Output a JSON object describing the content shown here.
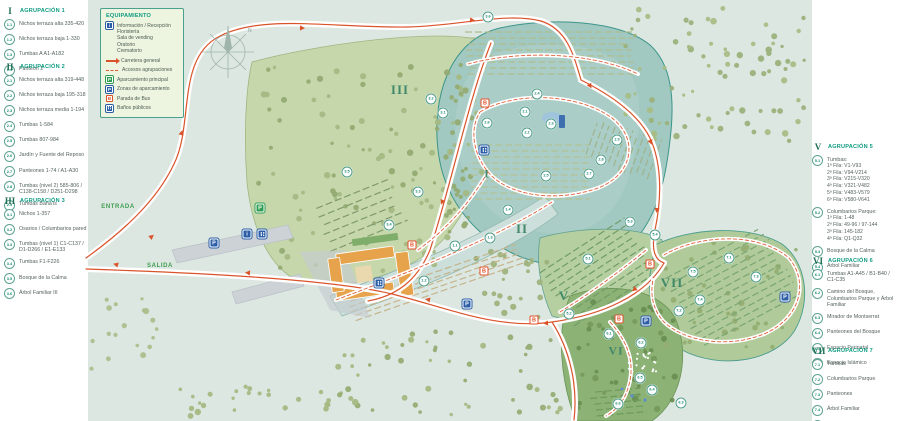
{
  "equipment": {
    "title": "EQUIPAMIENTO",
    "items": [
      {
        "icon": "info-icon",
        "lines": [
          "Información / Recepción",
          "Floristería",
          "Sala de vending",
          "Oratorio",
          "Crematorio"
        ]
      },
      {
        "icon": "main-road-icon",
        "lines": [
          "Carretera general"
        ]
      },
      {
        "icon": "access-road-icon",
        "lines": [
          "Accesos agrupaciones"
        ]
      },
      {
        "icon": "parking-main-icon",
        "lines": [
          "Aparcamiento principal"
        ]
      },
      {
        "icon": "parking-zone-icon",
        "lines": [
          "Zonas de aparcamiento"
        ]
      },
      {
        "icon": "bus-stop-icon",
        "lines": [
          "Parada de Bus"
        ]
      },
      {
        "icon": "wc-icon",
        "lines": [
          "Baños públicos"
        ]
      }
    ]
  },
  "legend_left": {
    "sections": [
      {
        "numeral": "I",
        "title": "AGRUPACIÓN 1",
        "top": 6,
        "items": [
          {
            "id": "1.1",
            "text": "Nichos terraza alta 335-420"
          },
          {
            "id": "1.2",
            "text": "Nichos terraza baja 1-330"
          },
          {
            "id": "1.3",
            "text": "Tumbas A A1-A182"
          },
          {
            "id": "1.4",
            "text": "Panteón 2"
          }
        ]
      },
      {
        "numeral": "II",
        "title": "AGRUPACIÓN 2",
        "top": 62,
        "items": [
          {
            "id": "2.1",
            "text": "Nichos terraza alta 319-448"
          },
          {
            "id": "2.2",
            "text": "Nichos terraza baja 195-318"
          },
          {
            "id": "2.3",
            "text": "Nichos terraza media 1-194"
          },
          {
            "id": "2.4",
            "text": "Tumbas 1-584"
          },
          {
            "id": "2.5",
            "text": "Tumbas 807-984"
          },
          {
            "id": "2.6",
            "text": "Jardín y Fuente del Reposo"
          },
          {
            "id": "2.7",
            "text": "Panteones 1-74 / A1-A30"
          },
          {
            "id": "2.8",
            "text": "Tumbas (nivel 2)  585-806 / C138-C158 / D251-D298"
          },
          {
            "id": "2.9",
            "text": "Tumbas Bahá'ís"
          }
        ]
      },
      {
        "numeral": "III",
        "title": "AGRUPACIÓN 3",
        "top": 196,
        "items": [
          {
            "id": "3.1",
            "text": "Nichos 1-357"
          },
          {
            "id": "3.2",
            "text": "Osarios / Columbarios pared"
          },
          {
            "id": "3.3",
            "text": "Tumbas (nivel 1)  C1-C137 / D1-D266 / E1-E133"
          },
          {
            "id": "3.4",
            "text": "Tumbas F1-F226"
          },
          {
            "id": "3.5",
            "text": "Bosque de la Calma"
          },
          {
            "id": "3.6",
            "text": "Árbol Familiar III"
          }
        ]
      }
    ]
  },
  "legend_right": {
    "sections": [
      {
        "numeral": "V",
        "title": "AGRUPACIÓN 5",
        "top": 142,
        "items": [
          {
            "id": "5.1",
            "text": "Tumbas:",
            "sub": [
              "1ª Fila: V1-V93",
              "2ª Fila: V94-V214",
              "3ª Fila: V215-V320",
              "4ª Fila: V321-V482",
              "5ª Fila: V483-V579",
              "6ª Fila: V580-V641"
            ]
          },
          {
            "id": "5.2",
            "text": "Columbarios Parque:",
            "sub": [
              "1ª Fila: 1-48",
              "2ª Fila: 49-96 / 97-144",
              "3ª Fila: 145-182",
              "4ª Fila: Q1-Q32"
            ]
          },
          {
            "id": "5.3",
            "text": "Bosque de la Calma"
          },
          {
            "id": "5.4",
            "text": "Árbol Familiar"
          }
        ]
      },
      {
        "numeral": "VI",
        "title": "AGRUPACIÓN 6",
        "top": 256,
        "items": [
          {
            "id": "6.1",
            "text": "Tumbas A1-A45 / B1-B40 / C1-C35"
          },
          {
            "id": "6.2",
            "text": "Camino del Bosque, Columbarios Parque y Árbol Familiar"
          },
          {
            "id": "6.3",
            "text": "Mirador de Montserrat"
          },
          {
            "id": "6.4",
            "text": "Panteones del Bosque"
          },
          {
            "id": "6.5",
            "text": "Espacio Perinatal"
          },
          {
            "id": "6.6",
            "text": "Espacio Islámico"
          }
        ]
      },
      {
        "numeral": "VII",
        "title": "AGRUPACIÓN 7",
        "top": 346,
        "items": [
          {
            "id": "7.1",
            "text": "Tumbas"
          },
          {
            "id": "7.2",
            "text": "Columbarios Parque"
          },
          {
            "id": "7.3",
            "text": "Panteones"
          },
          {
            "id": "7.4",
            "text": "Árbol Familiar"
          },
          {
            "id": "7.5",
            "text": "Bosque de la Calma"
          }
        ]
      }
    ]
  },
  "map": {
    "road_labels": [
      {
        "text": "ENTRADA",
        "x": 118,
        "y": 207
      },
      {
        "text": "SALIDA",
        "x": 160,
        "y": 266
      }
    ],
    "area_labels": [
      {
        "id": "I",
        "x": 487,
        "y": 174,
        "size": 12
      },
      {
        "id": "II",
        "x": 522,
        "y": 229,
        "size": 13
      },
      {
        "id": "III",
        "x": 400,
        "y": 90,
        "size": 13
      },
      {
        "id": "V",
        "x": 564,
        "y": 296,
        "size": 13
      },
      {
        "id": "VI",
        "x": 616,
        "y": 351,
        "size": 12
      },
      {
        "id": "VII",
        "x": 672,
        "y": 283,
        "size": 13
      }
    ],
    "markers": [
      {
        "id": "1.1",
        "x": 455,
        "y": 246
      },
      {
        "id": "1.2",
        "x": 424,
        "y": 281
      },
      {
        "id": "1.3",
        "x": 490,
        "y": 238
      },
      {
        "id": "1.4",
        "x": 508,
        "y": 210
      },
      {
        "id": "2.1",
        "x": 525,
        "y": 112
      },
      {
        "id": "2.2",
        "x": 527,
        "y": 133
      },
      {
        "id": "2.3",
        "x": 551,
        "y": 124
      },
      {
        "id": "2.4",
        "x": 537,
        "y": 94
      },
      {
        "id": "2.5",
        "x": 546,
        "y": 176
      },
      {
        "id": "2.6",
        "x": 487,
        "y": 123
      },
      {
        "id": "2.7",
        "x": 589,
        "y": 174
      },
      {
        "id": "2.8",
        "x": 601,
        "y": 160
      },
      {
        "id": "2.9",
        "x": 617,
        "y": 140
      },
      {
        "id": "3.1",
        "x": 443,
        "y": 113
      },
      {
        "id": "3.2",
        "x": 431,
        "y": 99
      },
      {
        "id": "3.3",
        "x": 418,
        "y": 192
      },
      {
        "id": "3.4",
        "x": 389,
        "y": 225
      },
      {
        "id": "3.5",
        "x": 347,
        "y": 172
      },
      {
        "id": "3.6",
        "x": 488,
        "y": 17
      },
      {
        "id": "5.1",
        "x": 588,
        "y": 259
      },
      {
        "id": "5.2",
        "x": 569,
        "y": 314
      },
      {
        "id": "5.3",
        "x": 630,
        "y": 222
      },
      {
        "id": "5.4",
        "x": 655,
        "y": 235
      },
      {
        "id": "6.1",
        "x": 609,
        "y": 334
      },
      {
        "id": "6.2",
        "x": 641,
        "y": 343
      },
      {
        "id": "6.3",
        "x": 681,
        "y": 403
      },
      {
        "id": "6.4",
        "x": 652,
        "y": 390
      },
      {
        "id": "6.5",
        "x": 640,
        "y": 378
      },
      {
        "id": "6.6",
        "x": 618,
        "y": 404
      },
      {
        "id": "7.1",
        "x": 729,
        "y": 258
      },
      {
        "id": "7.2",
        "x": 679,
        "y": 311
      },
      {
        "id": "7.3",
        "x": 756,
        "y": 277
      },
      {
        "id": "7.4",
        "x": 700,
        "y": 300
      },
      {
        "id": "7.5",
        "x": 693,
        "y": 272
      }
    ],
    "icons": [
      {
        "type": "parking-main-icon",
        "label": "P",
        "x": 260,
        "y": 208
      },
      {
        "type": "parking-zone-icon",
        "label": "P",
        "x": 214,
        "y": 243
      },
      {
        "type": "parking-zone-icon",
        "label": "P",
        "x": 467,
        "y": 304
      },
      {
        "type": "parking-zone-icon",
        "label": "P",
        "x": 646,
        "y": 321
      },
      {
        "type": "parking-zone-icon",
        "label": "P",
        "x": 785,
        "y": 297
      },
      {
        "type": "info-icon",
        "label": "i",
        "x": 247,
        "y": 234
      },
      {
        "type": "wc-icon",
        "label": "",
        "x": 262,
        "y": 234
      },
      {
        "type": "wc-icon",
        "label": "",
        "x": 484,
        "y": 150
      },
      {
        "type": "wc-icon",
        "label": "",
        "x": 379,
        "y": 283
      },
      {
        "type": "bus-stop-icon",
        "label": "B",
        "x": 485,
        "y": 103
      },
      {
        "type": "bus-stop-icon",
        "label": "B",
        "x": 412,
        "y": 245
      },
      {
        "type": "bus-stop-icon",
        "label": "B",
        "x": 484,
        "y": 271
      },
      {
        "type": "bus-stop-icon",
        "label": "B",
        "x": 534,
        "y": 320
      },
      {
        "type": "bus-stop-icon",
        "label": "B",
        "x": 619,
        "y": 319
      },
      {
        "type": "bus-stop-icon",
        "label": "B",
        "x": 650,
        "y": 264
      }
    ],
    "compass_letter": "N"
  },
  "colors": {
    "map_bg": "#dce7e2",
    "forest": "#c6d7ac",
    "zone2_teal": "#a2c8c2",
    "road_red": "#d9542b",
    "legend_green": "#0f9b82",
    "parking_blue": "#2b5ea7",
    "parking_green": "#2f9e52"
  }
}
